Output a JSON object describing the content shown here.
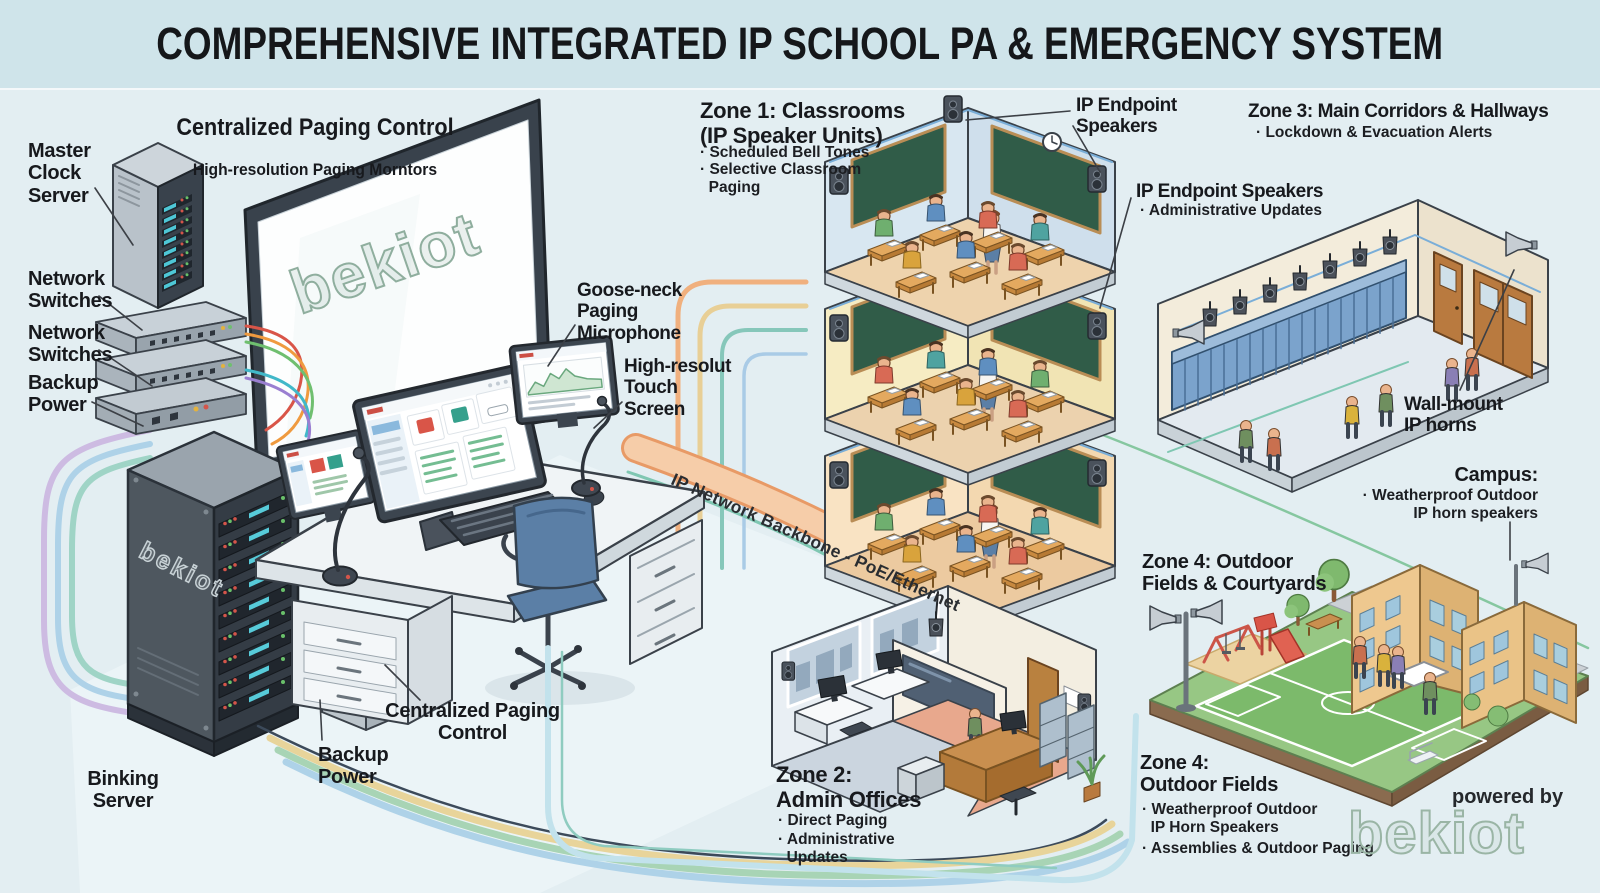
{
  "title": "COMPREHENSIVE INTEGRATED IP SCHOOL PA & EMERGENCY SYSTEM",
  "brand": {
    "logo": "bekiot",
    "powered_by": "powered by"
  },
  "backbone": {
    "label": "IP Network Backbone - PoE/Ethernet"
  },
  "control_center": {
    "heading": "Centralized Paging Control",
    "subheading": "High-resolution Paging Morntors",
    "master_clock": "Master\nClock\nServer",
    "network_switches_1": "Network\nSwitches",
    "network_switches_2": "Network\nSwitches",
    "backup_power_top": "Backup\nPower",
    "gooseneck_mic": "Goose-neck\nPaging\nMicrophone",
    "touch_screen": "High-resolut\nTouch\nScreen",
    "desk_label": "Centralized Paging\nControl",
    "backup_power_bottom": "Backup\nPower",
    "server_label": "Binking\nServer"
  },
  "zone1": {
    "heading": "Zone 1: Classrooms\n(IP Speaker Units)",
    "bullet_1": "· Scheduled Bell Tones",
    "bullet_2": "· Selective Classroom\n  Paging",
    "endpoint_speakers": "IP Endpoint\nSpeakers",
    "endpoint_speakers_2": "IP Endpoint Speakers",
    "endpoint_speakers_2_bullet": "· Administrative Updates"
  },
  "zone2": {
    "heading": "Zone 2:\nAdmin Offices",
    "bullet_1": "· Direct Paging",
    "bullet_2": "· Administrative\n  Updates"
  },
  "zone3": {
    "heading": "Zone 3: Main Corridors & Hallways",
    "bullet_1": "· Lockdown & Evacuation Alerts",
    "wall_mount": "Wall-mount\nIP horns"
  },
  "zone4": {
    "heading": "Zone 4: Outdoor\nFields & Courtyards",
    "campus_heading": "Campus:",
    "campus_bullet": "· Weatherproof Outdoor\nIP horn speakers",
    "fields_heading": "Zone 4:\nOutdoor Fields",
    "bullet_1": "· Weatherproof Outdoor\n  IP Horn Speakers",
    "bullet_2": "· Assemblies & Outdoor Paging"
  },
  "colors": {
    "header_bg": "#cfe4ea",
    "canvas_bg": "#e3eef2",
    "backbone_orange": "#f6cda9",
    "cable_yellow": "#e8d49a",
    "cable_green": "#a8d4b5",
    "cable_blue": "#aed2e8",
    "cable_purple": "#cdbbe2",
    "cable_teal": "#8fccc0",
    "locker_blue": "#7ba3cc",
    "chalkboard_green": "#33604c",
    "field_green": "#7fbf72",
    "brand_red": "#c97b6d",
    "brand_green": "#7fae98"
  }
}
